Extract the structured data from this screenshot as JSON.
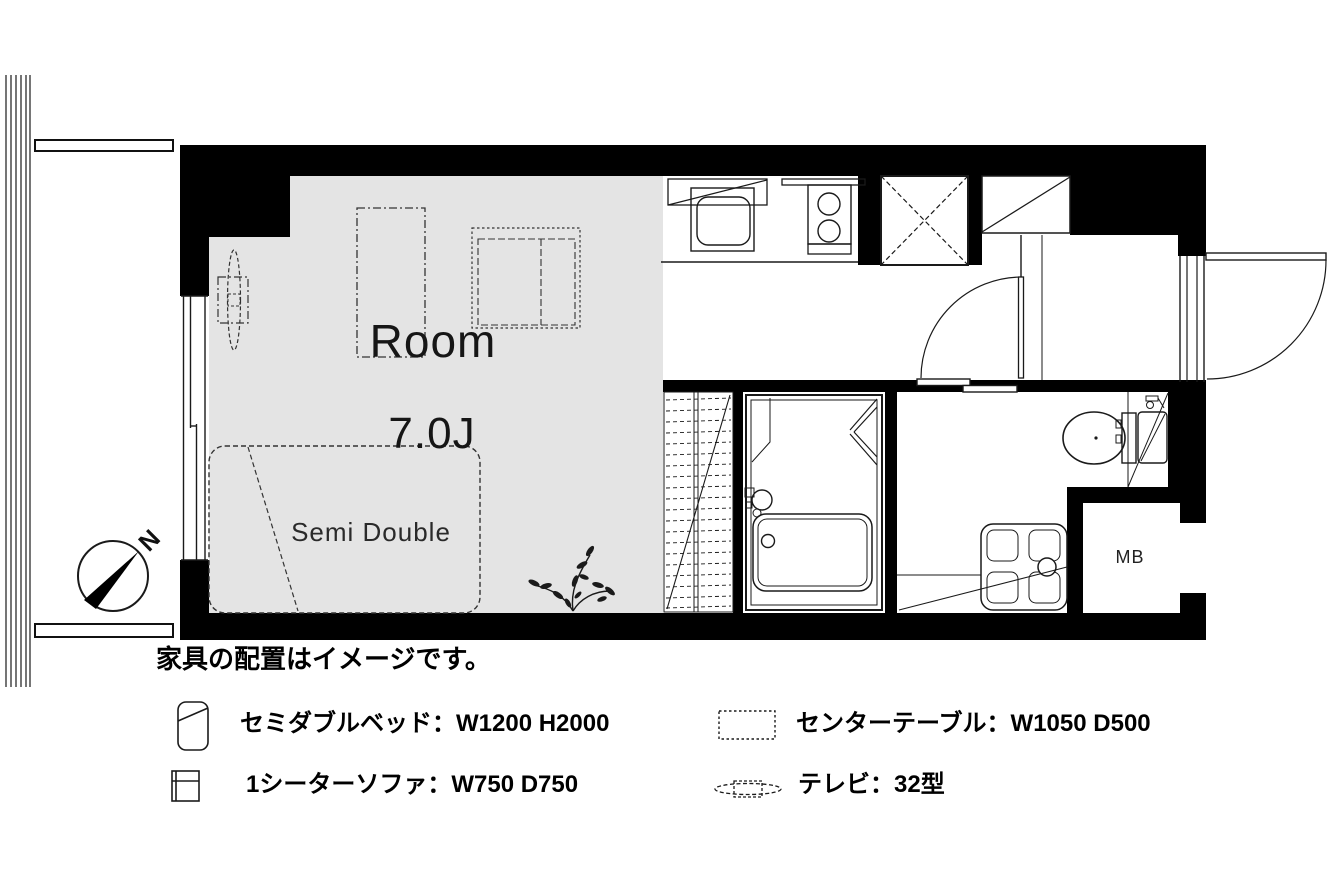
{
  "plan": {
    "room": {
      "label": "Room",
      "size": "7.0J"
    },
    "bed_label": "Semi Double",
    "meter_box_label": "MB",
    "compass_north": "N"
  },
  "caption": "家具の配置はイメージです。",
  "legend": {
    "items": [
      {
        "name": "semi-double-bed",
        "label": "セミダブルベッド：W1200 H2000"
      },
      {
        "name": "center-table",
        "label": "センターテーブル：W1050 D500"
      },
      {
        "name": "one-seater-sofa",
        "label": "1シーターソファ：W750 D750"
      },
      {
        "name": "tv",
        "label": "テレビ：32型"
      }
    ]
  },
  "colors": {
    "wall": "#000000",
    "room_floor": "#e4e4e4",
    "line": "#1a1a1a",
    "background": "#ffffff"
  }
}
